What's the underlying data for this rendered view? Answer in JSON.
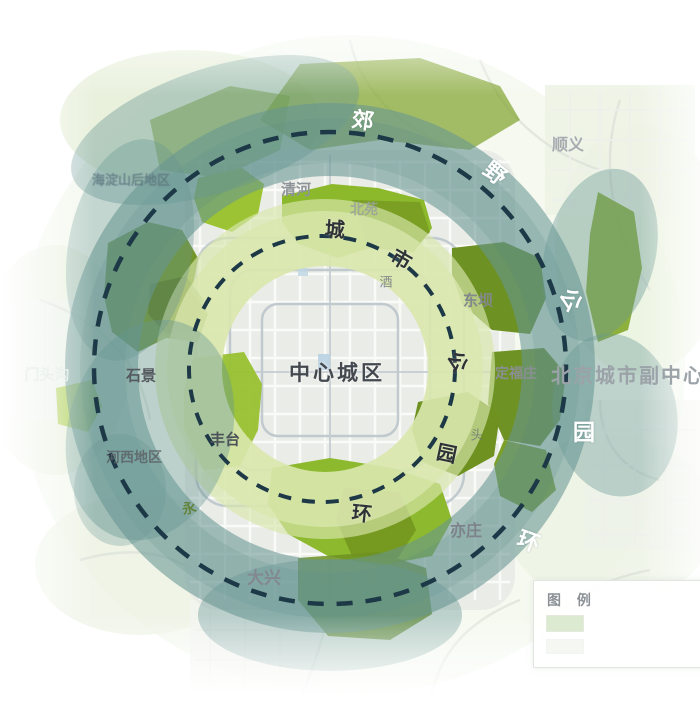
{
  "center_label": "中心城区",
  "rings": {
    "inner": {
      "name": "城市公园环",
      "chars": [
        "城",
        "市",
        "公",
        "园",
        "环"
      ]
    },
    "outer": {
      "name": "郊野公园环",
      "chars": [
        "郊",
        "野",
        "公",
        "园",
        "环"
      ]
    }
  },
  "places": [
    {
      "name": "顺义"
    },
    {
      "name": "清河"
    },
    {
      "name": "北苑"
    },
    {
      "name": "海淀山后地区"
    },
    {
      "name": "酒"
    },
    {
      "name": "东坝"
    },
    {
      "name": "定福庄"
    },
    {
      "name": "北京城市副中心"
    },
    {
      "name": "门头沟"
    },
    {
      "name": "石景"
    },
    {
      "name": "丰台"
    },
    {
      "name": "河西地区"
    },
    {
      "name": "永"
    },
    {
      "name": "头"
    },
    {
      "name": "大兴"
    },
    {
      "name": "亦庄"
    }
  ],
  "legend": {
    "title": "图 例"
  },
  "colors": {
    "city_park_ring": "#d8e6ab",
    "suburban_park_ring": "#679693",
    "green_patch_bright": "#8cb92d",
    "green_patch_dark": "#6d9121",
    "boundary_dash": "#1d3947"
  }
}
